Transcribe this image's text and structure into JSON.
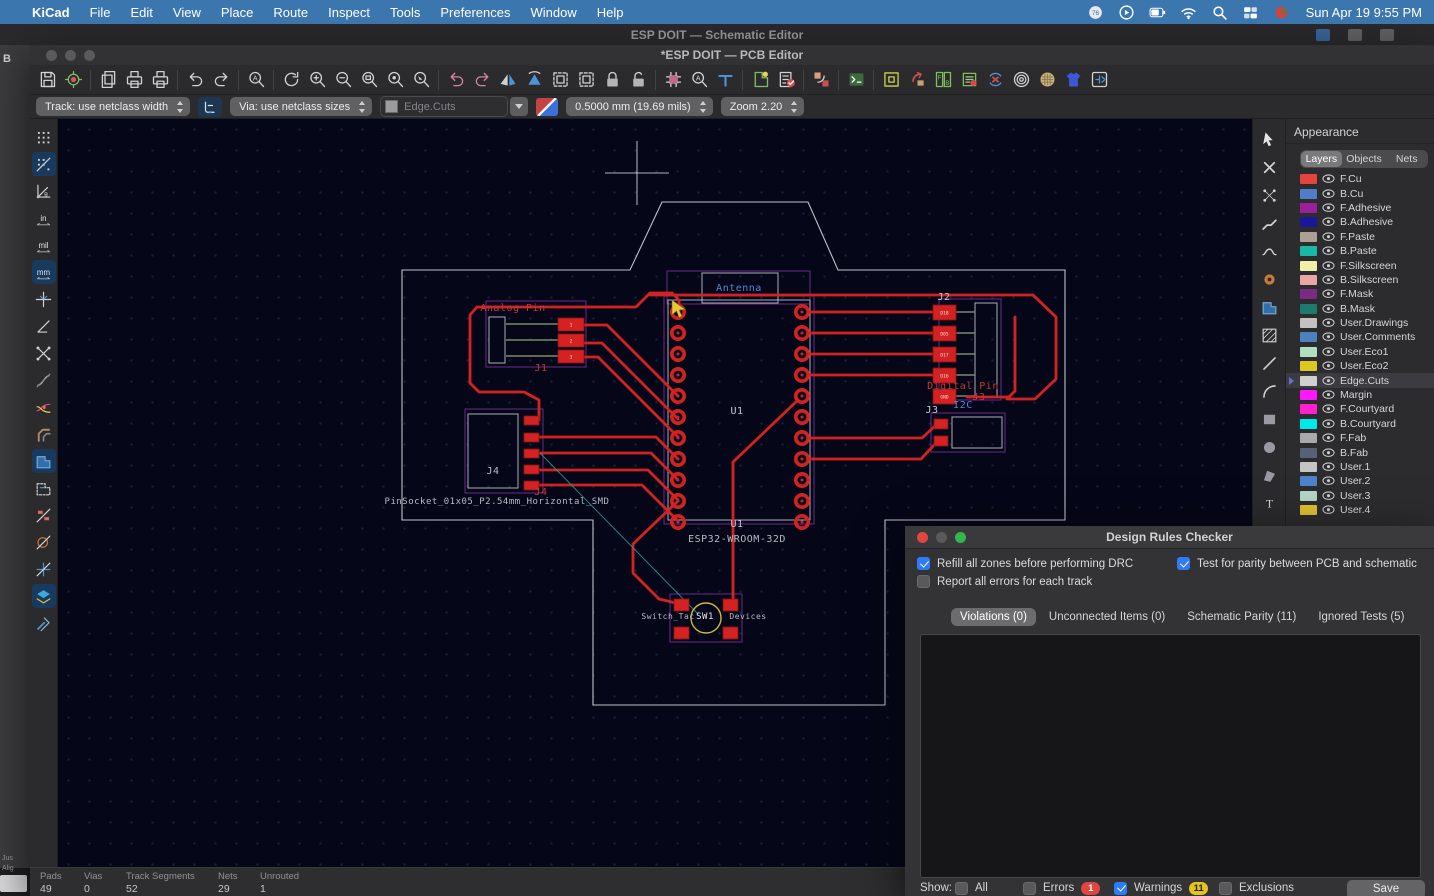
{
  "menubar": {
    "items": [
      "KiCad",
      "File",
      "Edit",
      "View",
      "Place",
      "Route",
      "Inspect",
      "Tools",
      "Preferences",
      "Window",
      "Help"
    ],
    "status_icons": [
      "gauge-badge-icon",
      "play-icon",
      "battery-icon",
      "wifi-icon",
      "search-icon",
      "displays-icon",
      "flag-icon"
    ],
    "clock": "Sun Apr 19  9:55 PM"
  },
  "schematic_window": {
    "title": "ESP DOIT — Schematic Editor",
    "sliver_letter": "B",
    "sliver_t1": "Jus",
    "sliver_t2": "Alig"
  },
  "pcb_window": {
    "title": "*ESP DOIT — PCB Editor"
  },
  "toolbar": {
    "items": [
      {
        "name": "save",
        "kind": "disk"
      },
      {
        "name": "board-setup",
        "kind": "gearboard"
      },
      {
        "sep": true
      },
      {
        "name": "page-settings",
        "kind": "pages"
      },
      {
        "name": "print",
        "kind": "print"
      },
      {
        "name": "plot",
        "kind": "print"
      },
      {
        "sep": true
      },
      {
        "name": "undo",
        "kind": "undo"
      },
      {
        "name": "redo",
        "kind": "redo"
      },
      {
        "sep": true
      },
      {
        "name": "find",
        "kind": "magA"
      },
      {
        "sep": true
      },
      {
        "name": "refresh",
        "kind": "refresh"
      },
      {
        "name": "zoom-in",
        "kind": "magP"
      },
      {
        "name": "zoom-out",
        "kind": "magM"
      },
      {
        "name": "zoom-to-fit",
        "kind": "magR"
      },
      {
        "name": "zoom-to-objects",
        "kind": "magO"
      },
      {
        "name": "zoom-to-selection",
        "kind": "magS"
      },
      {
        "sep": true
      },
      {
        "name": "rotate-ccw",
        "kind": "rotl"
      },
      {
        "name": "rotate-cw",
        "kind": "rotr"
      },
      {
        "name": "flip-horizontal",
        "kind": "tri"
      },
      {
        "name": "flip-vertical",
        "kind": "tri2"
      },
      {
        "name": "group",
        "kind": "group"
      },
      {
        "name": "ungroup",
        "kind": "group"
      },
      {
        "name": "lock",
        "kind": "lock"
      },
      {
        "name": "unlock",
        "kind": "unlock"
      },
      {
        "sep": true
      },
      {
        "name": "edit-footprints",
        "kind": "chipP"
      },
      {
        "name": "search-footprints",
        "kind": "magA"
      },
      {
        "name": "drill-origin",
        "kind": "tee"
      },
      {
        "sep": true
      },
      {
        "name": "update-pcb-from-schematic",
        "kind": "updg"
      },
      {
        "name": "design-rules-checker",
        "kind": "checkl"
      },
      {
        "sep": true
      },
      {
        "name": "swap-layers",
        "kind": "swap"
      },
      {
        "sep": true
      },
      {
        "name": "scripting-console",
        "kind": "console"
      },
      {
        "sep": true
      },
      {
        "name": "flip-board-view",
        "kind": "frame"
      },
      {
        "name": "back-annotate",
        "kind": "backa"
      },
      {
        "name": "footprint-position-file",
        "kind": "fbgrid"
      },
      {
        "name": "footprint-checker",
        "kind": "chipC"
      },
      {
        "name": "sync-schematic",
        "kind": "syncx"
      },
      {
        "name": "zone-display",
        "kind": "rings"
      },
      {
        "name": "freeroute",
        "kind": "roundg"
      },
      {
        "name": "3d-viewer",
        "kind": "shirt"
      },
      {
        "name": "plugin-manager",
        "kind": "plug"
      }
    ]
  },
  "controls": {
    "track": "Track: use netclass width",
    "via": "Via: use netclass sizes",
    "layer": "Edge.Cuts",
    "grid": "0.5000 mm (19.69 mils)",
    "zoom": "Zoom 2.20"
  },
  "left_toolbar": [
    {
      "name": "grid-visibility",
      "kind": "dots"
    },
    {
      "name": "grid-overrides",
      "kind": "dotslash",
      "active": true
    },
    {
      "name": "polar-coordinates",
      "kind": "polar"
    },
    {
      "name": "units-inches",
      "kind": "txt",
      "label": "in"
    },
    {
      "name": "units-mils",
      "kind": "txt",
      "label": "mil"
    },
    {
      "name": "units-mm",
      "kind": "txt",
      "label": "mm",
      "active": true
    },
    {
      "name": "full-window-crosshair",
      "kind": "crossstar"
    },
    {
      "name": "free-angle-mode",
      "kind": "angle"
    },
    {
      "name": "ratsnest-visibility",
      "kind": "rats"
    },
    {
      "name": "curved-ratsnest",
      "kind": "ratscurve"
    },
    {
      "name": "net-color-mode",
      "kind": "netcolors"
    },
    {
      "name": "track-display-mode",
      "kind": "tracks"
    },
    {
      "name": "zone-fill-display",
      "kind": "zonefill",
      "active": true
    },
    {
      "name": "zone-outline-display",
      "kind": "zoneout"
    },
    {
      "name": "pad-sketch-mode",
      "kind": "padslash"
    },
    {
      "name": "via-sketch-mode",
      "kind": "viaslash"
    },
    {
      "name": "track-sketch-mode",
      "kind": "crossslash"
    },
    {
      "name": "high-contrast-mode",
      "kind": "layers",
      "active": true
    },
    {
      "name": "properties-panel",
      "kind": "tools"
    }
  ],
  "right_toolbar": [
    {
      "name": "select-tool",
      "kind": "arrow"
    },
    {
      "name": "interactive-delete-tool",
      "kind": "xcross"
    },
    {
      "name": "local-ratsnest-tool",
      "kind": "dotgrid"
    },
    {
      "name": "route-tracks-tool",
      "kind": "squig"
    },
    {
      "name": "tune-length-tool",
      "kind": "squig2"
    },
    {
      "name": "add-via-tool",
      "kind": "viadot"
    },
    {
      "name": "add-filled-zone-tool",
      "kind": "zoneblue"
    },
    {
      "name": "add-rule-area-tool",
      "kind": "hatch"
    },
    {
      "name": "draw-line-tool",
      "kind": "line"
    },
    {
      "name": "draw-arc-tool",
      "kind": "arc"
    },
    {
      "name": "draw-rectangle-tool",
      "kind": "rects"
    },
    {
      "name": "draw-circle-tool",
      "kind": "circ"
    },
    {
      "name": "draw-polygon-tool",
      "kind": "poly"
    },
    {
      "name": "add-text-tool",
      "kind": "textT"
    },
    {
      "name": "add-dimension-tool",
      "kind": "dim"
    },
    {
      "name": "place-image-tool",
      "kind": "img"
    }
  ],
  "appearance": {
    "title": "Appearance",
    "tabs": [
      "Layers",
      "Objects",
      "Nets"
    ],
    "active_tab": 0,
    "layers": [
      {
        "name": "F.Cu",
        "color": "#e2453e"
      },
      {
        "name": "B.Cu",
        "color": "#4d7ec7"
      },
      {
        "name": "F.Adhesive",
        "color": "#9b1f9b"
      },
      {
        "name": "B.Adhesive",
        "color": "#1a1899"
      },
      {
        "name": "F.Paste",
        "color": "#aca094"
      },
      {
        "name": "B.Paste",
        "color": "#18b8a8"
      },
      {
        "name": "F.Silkscreen",
        "color": "#f2f0a6"
      },
      {
        "name": "B.Silkscreen",
        "color": "#e8a7a2"
      },
      {
        "name": "F.Mask",
        "color": "#7b2c80"
      },
      {
        "name": "B.Mask",
        "color": "#1d7a6c"
      },
      {
        "name": "User.Drawings",
        "color": "#c2c2c2"
      },
      {
        "name": "User.Comments",
        "color": "#4c80c0"
      },
      {
        "name": "User.Eco1",
        "color": "#aee0c0"
      },
      {
        "name": "User.Eco2",
        "color": "#e0c720"
      },
      {
        "name": "Edge.Cuts",
        "color": "#d0d0ce",
        "selected": true
      },
      {
        "name": "Margin",
        "color": "#ff18ff"
      },
      {
        "name": "F.Courtyard",
        "color": "#ff20d0"
      },
      {
        "name": "B.Courtyard",
        "color": "#00e8e8"
      },
      {
        "name": "F.Fab",
        "color": "#a9a9a9"
      },
      {
        "name": "B.Fab",
        "color": "#586078"
      },
      {
        "name": "User.1",
        "color": "#c5c5c5"
      },
      {
        "name": "User.2",
        "color": "#4f82cc"
      },
      {
        "name": "User.3",
        "color": "#b3d6c5"
      },
      {
        "name": "User.4",
        "color": "#dfc02f"
      }
    ]
  },
  "drc": {
    "title": "Design Rules Checker",
    "options": [
      {
        "label": "Refill all zones before performing DRC",
        "checked": true,
        "x": 12,
        "y": 31
      },
      {
        "label": "Report all errors for each track",
        "checked": false,
        "x": 12,
        "y": 49
      },
      {
        "label": "Test for parity between PCB and schematic",
        "checked": true,
        "x": 272,
        "y": 31
      }
    ],
    "tabs": [
      {
        "label": "Violations (0)",
        "active": true
      },
      {
        "label": "Unconnected Items (0)"
      },
      {
        "label": "Schematic Parity (11)"
      },
      {
        "label": "Ignored Tests (5)"
      }
    ],
    "footer": {
      "show_label": "Show:",
      "filters": [
        {
          "label": "All",
          "checked": false,
          "x": 50
        },
        {
          "label": "Errors",
          "checked": false,
          "x": 118,
          "badge": "1",
          "badge_color": "#df4640"
        },
        {
          "label": "Warnings",
          "checked": true,
          "x": 209,
          "badge": "11",
          "badge_color": "#e3c31e"
        },
        {
          "label": "Exclusions",
          "checked": false,
          "x": 314
        }
      ],
      "save_label": "Save"
    }
  },
  "statusbar": {
    "items": [
      {
        "label": "Pads",
        "value": "49",
        "x": 10
      },
      {
        "label": "Vias",
        "value": "0",
        "x": 54
      },
      {
        "label": "Track Segments",
        "value": "52",
        "x": 96
      },
      {
        "label": "Nets",
        "value": "29",
        "x": 188
      },
      {
        "label": "Unrouted",
        "value": "1",
        "x": 230
      }
    ]
  },
  "canvas": {
    "trace_color": "#d42222",
    "pad_color": "#d42222",
    "outline_color": "#d6d6de",
    "courtyard_color": "#6a2a8a",
    "fab_color": "#c9c9d4",
    "board_outline": "402,270 630,270 662,202 808,202 838,270 1065,270 1065,520 885,520 885,705 593,705 593,520 402,520",
    "traces": [
      "539,420 539,400 524,392 479,392 470,383 470,315 477,307 636,307 650,293 672,293 679,300 679,312",
      "650,295 1033,295 1056,317 1056,379 1035,399 1007,399",
      "810,312 941,312",
      "810,333 941,333",
      "810,354 941,354",
      "810,375 941,375",
      "967,397 1009,397 1015,391 1015,317",
      "810,438 922,438 936,425 941,425",
      "810,459 921,459 936,443 941,443",
      "798,400 733,462 733,600 731,604",
      "678,501 633,544 633,573 659,599 680,604",
      "584,325 607,325 678,396",
      "584,343 602,343 678,419",
      "584,357 598,357 678,437",
      "539,437 656,437 678,459",
      "539,453 651,453 678,480",
      "539,470 648,470 678,500",
      "539,485 642,485 678,521"
    ],
    "u1_pads": {
      "left_x": 678,
      "right_x": 802,
      "y_start": 312,
      "y_step": 21,
      "count": 11
    },
    "rect_pads": [
      {
        "x": 558,
        "y": 318,
        "w": 26,
        "h": 13,
        "label": "1"
      },
      {
        "x": 558,
        "y": 334,
        "w": 26,
        "h": 13,
        "label": "2"
      },
      {
        "x": 558,
        "y": 350,
        "w": 26,
        "h": 13,
        "label": "3"
      },
      {
        "x": 933,
        "y": 305,
        "w": 23,
        "h": 15,
        "label": "D18"
      },
      {
        "x": 933,
        "y": 326,
        "w": 23,
        "h": 15,
        "label": "D05"
      },
      {
        "x": 933,
        "y": 347,
        "w": 23,
        "h": 15,
        "label": "D17"
      },
      {
        "x": 933,
        "y": 368,
        "w": 23,
        "h": 15,
        "label": "D16"
      },
      {
        "x": 933,
        "y": 389,
        "w": 23,
        "h": 15,
        "label": "GND"
      },
      {
        "x": 524,
        "y": 416,
        "w": 15,
        "h": 9,
        "label": ""
      },
      {
        "x": 524,
        "y": 433,
        "w": 15,
        "h": 9,
        "label": ""
      },
      {
        "x": 524,
        "y": 449,
        "w": 15,
        "h": 9,
        "label": ""
      },
      {
        "x": 524,
        "y": 465,
        "w": 15,
        "h": 9,
        "label": ""
      },
      {
        "x": 524,
        "y": 481,
        "w": 15,
        "h": 9,
        "label": ""
      },
      {
        "x": 934,
        "y": 419,
        "w": 14,
        "h": 10,
        "label": ""
      },
      {
        "x": 934,
        "y": 436,
        "w": 14,
        "h": 10,
        "label": ""
      },
      {
        "x": 674,
        "y": 599,
        "w": 15,
        "h": 12,
        "label": ""
      },
      {
        "x": 723,
        "y": 599,
        "w": 15,
        "h": 12,
        "label": ""
      },
      {
        "x": 674,
        "y": 627,
        "w": 15,
        "h": 12,
        "label": ""
      },
      {
        "x": 723,
        "y": 627,
        "w": 15,
        "h": 12,
        "label": ""
      }
    ],
    "courtyards": [
      {
        "x": 664,
        "y": 296,
        "w": 150,
        "h": 228
      },
      {
        "x": 667,
        "y": 271,
        "w": 143,
        "h": 33
      },
      {
        "x": 486,
        "y": 301,
        "w": 100,
        "h": 66
      },
      {
        "x": 465,
        "y": 409,
        "w": 78,
        "h": 84
      },
      {
        "x": 939,
        "y": 299,
        "w": 62,
        "h": 101
      },
      {
        "x": 931,
        "y": 413,
        "w": 74,
        "h": 39
      },
      {
        "x": 670,
        "y": 594,
        "w": 72,
        "h": 48
      }
    ],
    "fab_boxes": [
      {
        "x": 668,
        "y": 300,
        "w": 142,
        "h": 220
      },
      {
        "x": 702,
        "y": 273,
        "w": 76,
        "h": 30
      },
      {
        "x": 489,
        "y": 317,
        "w": 16,
        "h": 46
      },
      {
        "x": 468,
        "y": 414,
        "w": 50,
        "h": 74
      },
      {
        "x": 975,
        "y": 303,
        "w": 22,
        "h": 94
      },
      {
        "x": 952,
        "y": 417,
        "w": 50,
        "h": 31
      }
    ],
    "stubs": [
      [
        506,
        324,
        558,
        324
      ],
      [
        506,
        340,
        558,
        340
      ],
      [
        506,
        356,
        558,
        356
      ],
      [
        956,
        312,
        975,
        312
      ],
      [
        956,
        333,
        975,
        333
      ],
      [
        956,
        354,
        975,
        354
      ],
      [
        956,
        375,
        975,
        375
      ],
      [
        956,
        396,
        975,
        396
      ]
    ],
    "sw_circle": {
      "cx": 706,
      "cy": 618,
      "r": 15,
      "color": "#cdbb3a"
    },
    "ratsnest": [
      [
        540,
        453,
        698,
        614
      ]
    ],
    "ratsnest_color": "#2a9a96",
    "crosshair": {
      "x": 637,
      "y": 173
    },
    "cursor": {
      "x": 672,
      "y": 300
    },
    "labels": [
      {
        "text": "Antenna",
        "x": 739,
        "y": 291,
        "color": "#4f86d8",
        "size": 10
      },
      {
        "text": "Analog Pin",
        "x": 513,
        "y": 311,
        "color": "#c23a34",
        "size": 10
      },
      {
        "text": "J1",
        "x": 541,
        "y": 371,
        "color": "#c23a34",
        "size": 10
      },
      {
        "text": "U1",
        "x": 737,
        "y": 414,
        "color": "#c9c9d4",
        "size": 10
      },
      {
        "text": "U1",
        "x": 737,
        "y": 527,
        "color": "#c9c9d4",
        "size": 10
      },
      {
        "text": "ESP32-WROOM-32D",
        "x": 737,
        "y": 542,
        "color": "#b9b9c4",
        "size": 10
      },
      {
        "text": "J4",
        "x": 493,
        "y": 474,
        "color": "#b9b9c4",
        "size": 10
      },
      {
        "text": "J4",
        "x": 541,
        "y": 495,
        "color": "#c23a34",
        "size": 10
      },
      {
        "text": "PinSocket_01x05_P2.54mm_Horizontal_SMD",
        "x": 497,
        "y": 504,
        "color": "#b9b9c4",
        "size": 9
      },
      {
        "text": "J2",
        "x": 944,
        "y": 300,
        "color": "#c9c9d4",
        "size": 10
      },
      {
        "text": "Digital Pin",
        "x": 963,
        "y": 389,
        "color": "#c23a34",
        "size": 10
      },
      {
        "text": "J3",
        "x": 979,
        "y": 400,
        "color": "#c23a34",
        "size": 10
      },
      {
        "text": "I2C",
        "x": 963,
        "y": 408,
        "color": "#4f86d8",
        "size": 10
      },
      {
        "text": "J3",
        "x": 932,
        "y": 413,
        "color": "#c9c9d4",
        "size": 10
      },
      {
        "text": "Switch_Tac",
        "x": 668,
        "y": 619,
        "color": "#b9b9c4",
        "size": 8
      },
      {
        "text": "SW1",
        "x": 705,
        "y": 619,
        "color": "#e8e8ee",
        "size": 9
      },
      {
        "text": "Devices",
        "x": 748,
        "y": 619,
        "color": "#b9b9c4",
        "size": 8
      }
    ]
  }
}
